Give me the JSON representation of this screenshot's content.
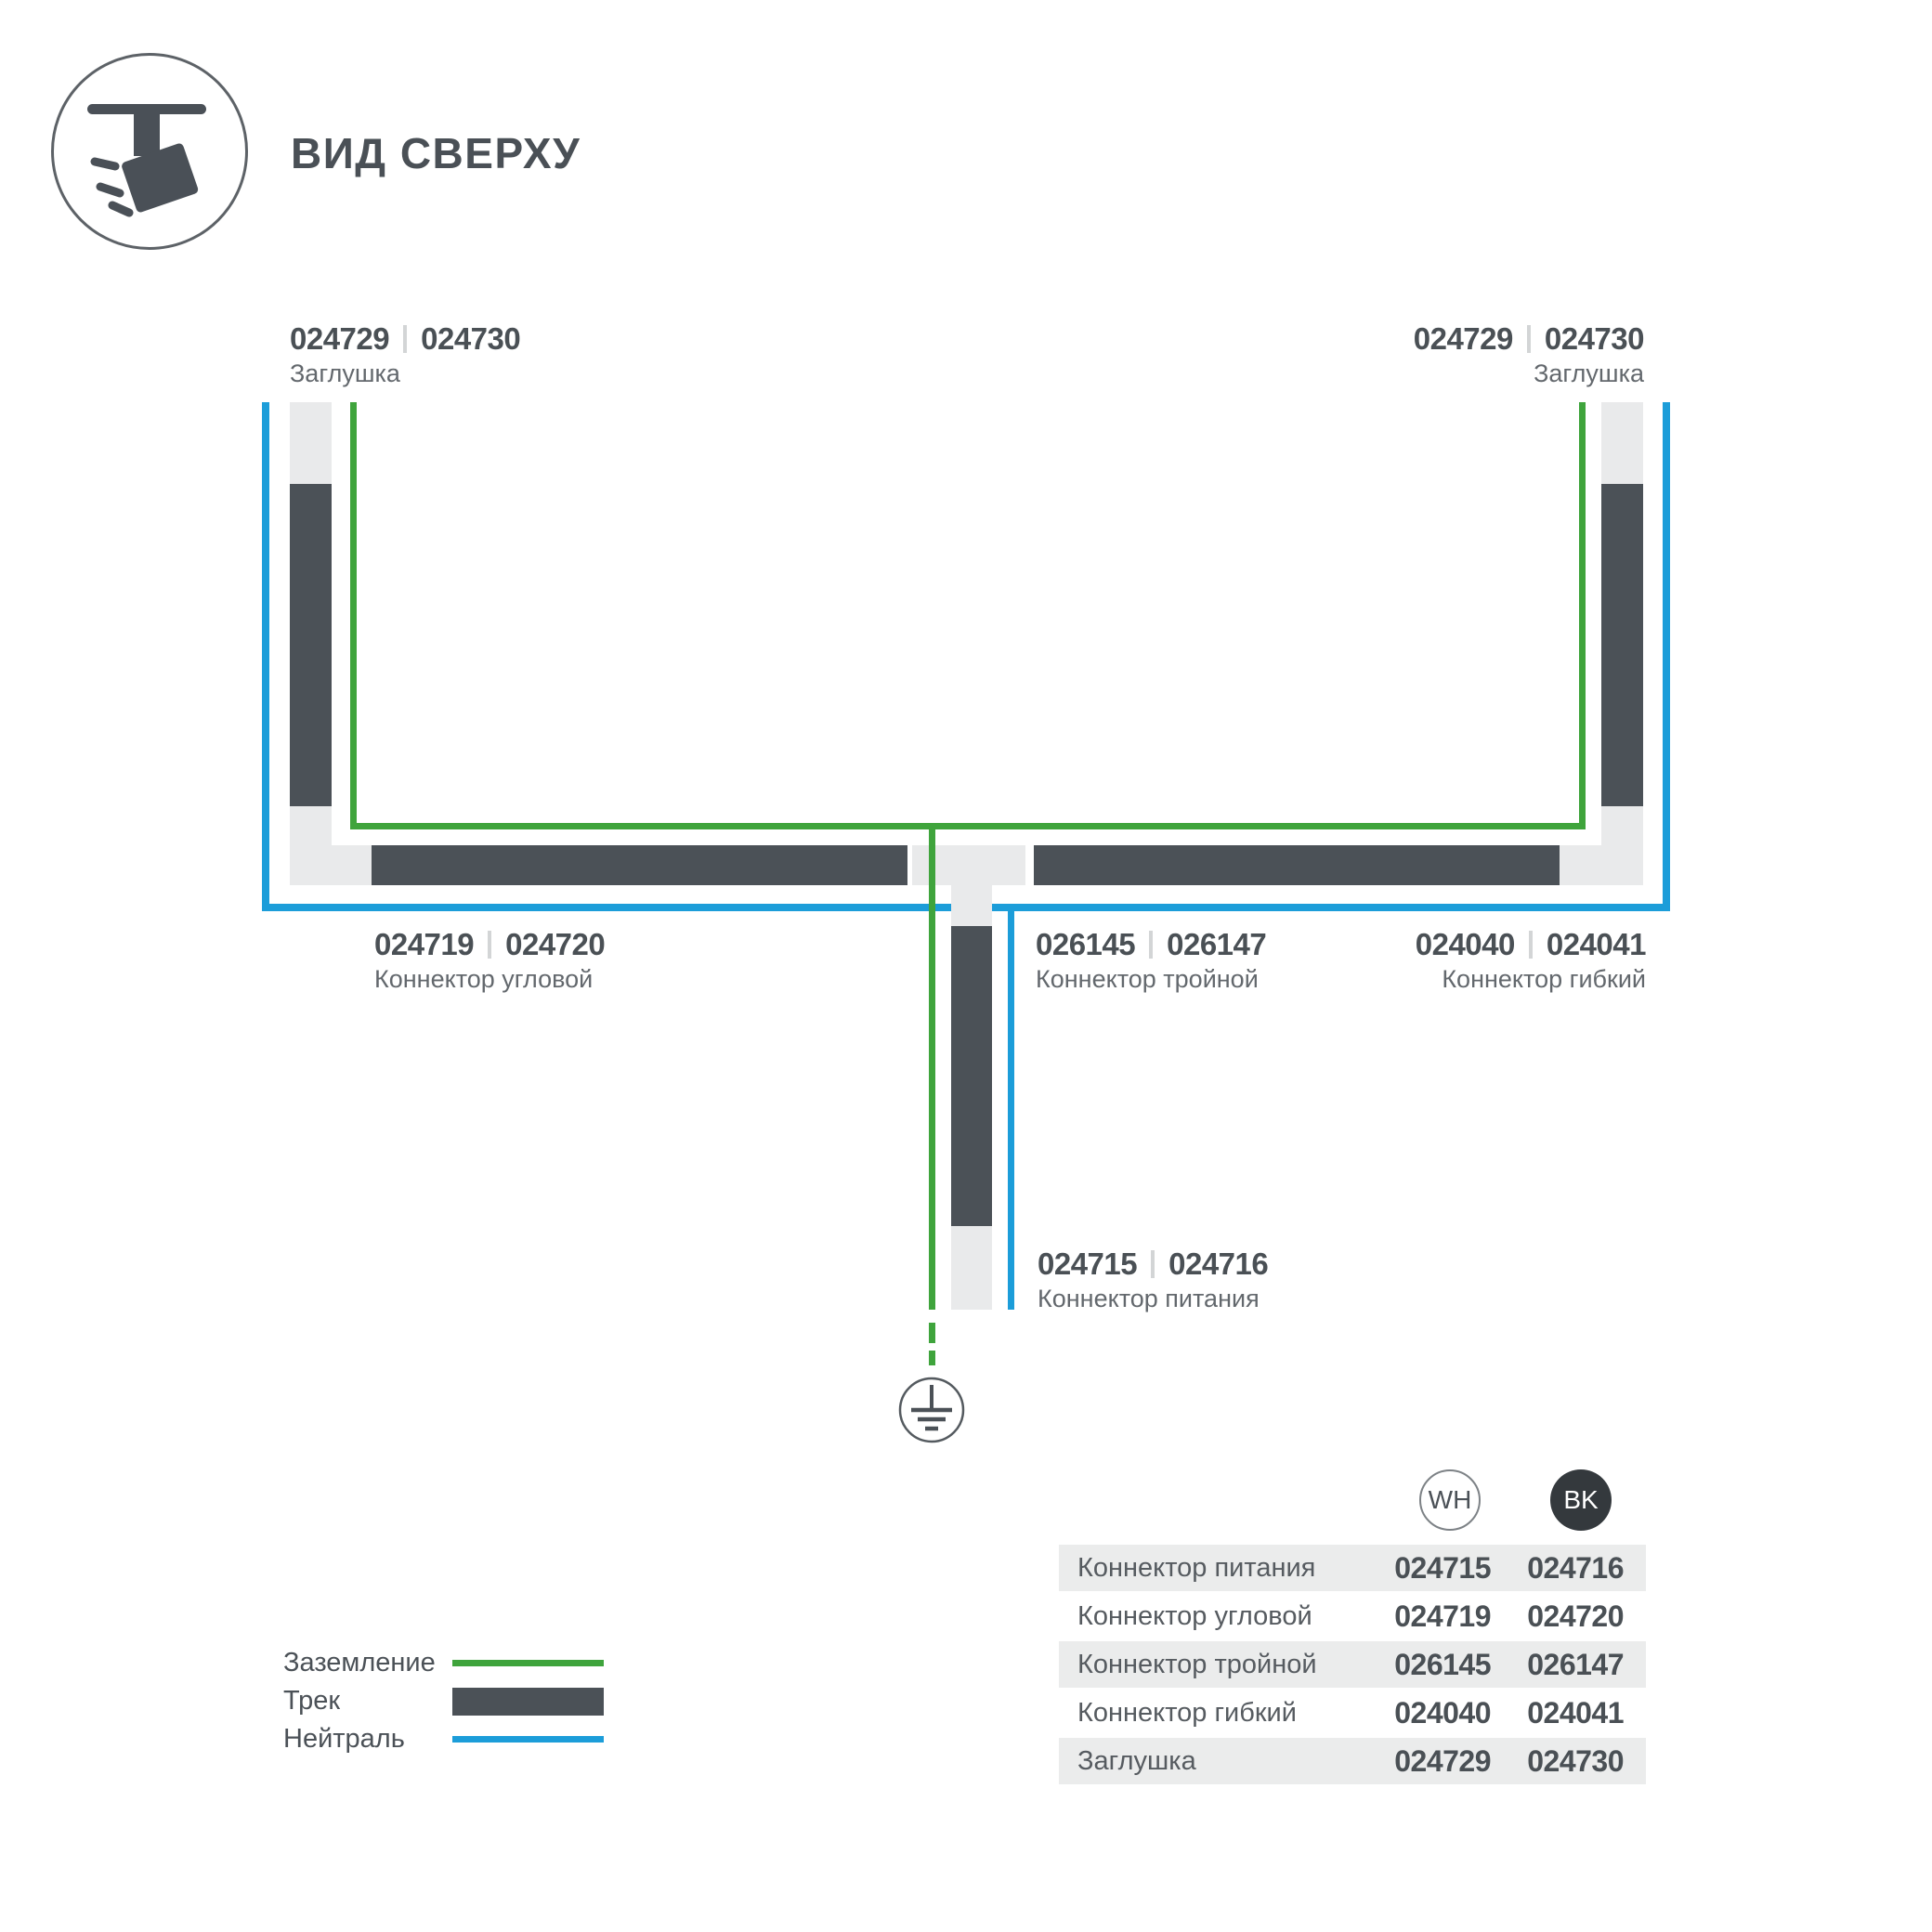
{
  "header": {
    "title": "ВИД СВЕРХУ"
  },
  "diagram": {
    "labels": {
      "endcap_left": {
        "codes": [
          "024729",
          "024730"
        ],
        "name": "Заглушка"
      },
      "endcap_right": {
        "codes": [
          "024729",
          "024730"
        ],
        "name": "Заглушка"
      },
      "corner": {
        "codes": [
          "024719",
          "024720"
        ],
        "name": "Коннектор угловой"
      },
      "triple": {
        "codes": [
          "026145",
          "026147"
        ],
        "name": "Коннектор тройной"
      },
      "flexible": {
        "codes": [
          "024040",
          "024041"
        ],
        "name": "Коннектор гибкий"
      },
      "power": {
        "codes": [
          "024715",
          "024716"
        ],
        "name": "Коннектор питания"
      }
    }
  },
  "legend": {
    "items": [
      {
        "label": "Заземление",
        "type": "ground",
        "color": "#3fa43c"
      },
      {
        "label": "Трек",
        "type": "track",
        "color": "#4b5157"
      },
      {
        "label": "Нейтраль",
        "type": "neutral",
        "color": "#1c9dd9"
      }
    ]
  },
  "table": {
    "columns": [
      {
        "code": "WH"
      },
      {
        "code": "BK"
      }
    ],
    "rows": [
      {
        "name": "Коннектор питания",
        "wh": "024715",
        "bk": "024716"
      },
      {
        "name": "Коннектор угловой",
        "wh": "024719",
        "bk": "024720"
      },
      {
        "name": "Коннектор тройной",
        "wh": "026145",
        "bk": "026147"
      },
      {
        "name": "Коннектор гибкий",
        "wh": "024040",
        "bk": "024041"
      },
      {
        "name": "Заглушка",
        "wh": "024729",
        "bk": "024730"
      }
    ]
  },
  "colors": {
    "track_dark": "#4b5157",
    "connector_light": "#e9eaeb",
    "ground_green": "#3fa43c",
    "neutral_blue": "#1c9dd9",
    "table_row_shade": "#ebecec",
    "text_primary": "#4a5055",
    "text_secondary": "#63686d"
  }
}
